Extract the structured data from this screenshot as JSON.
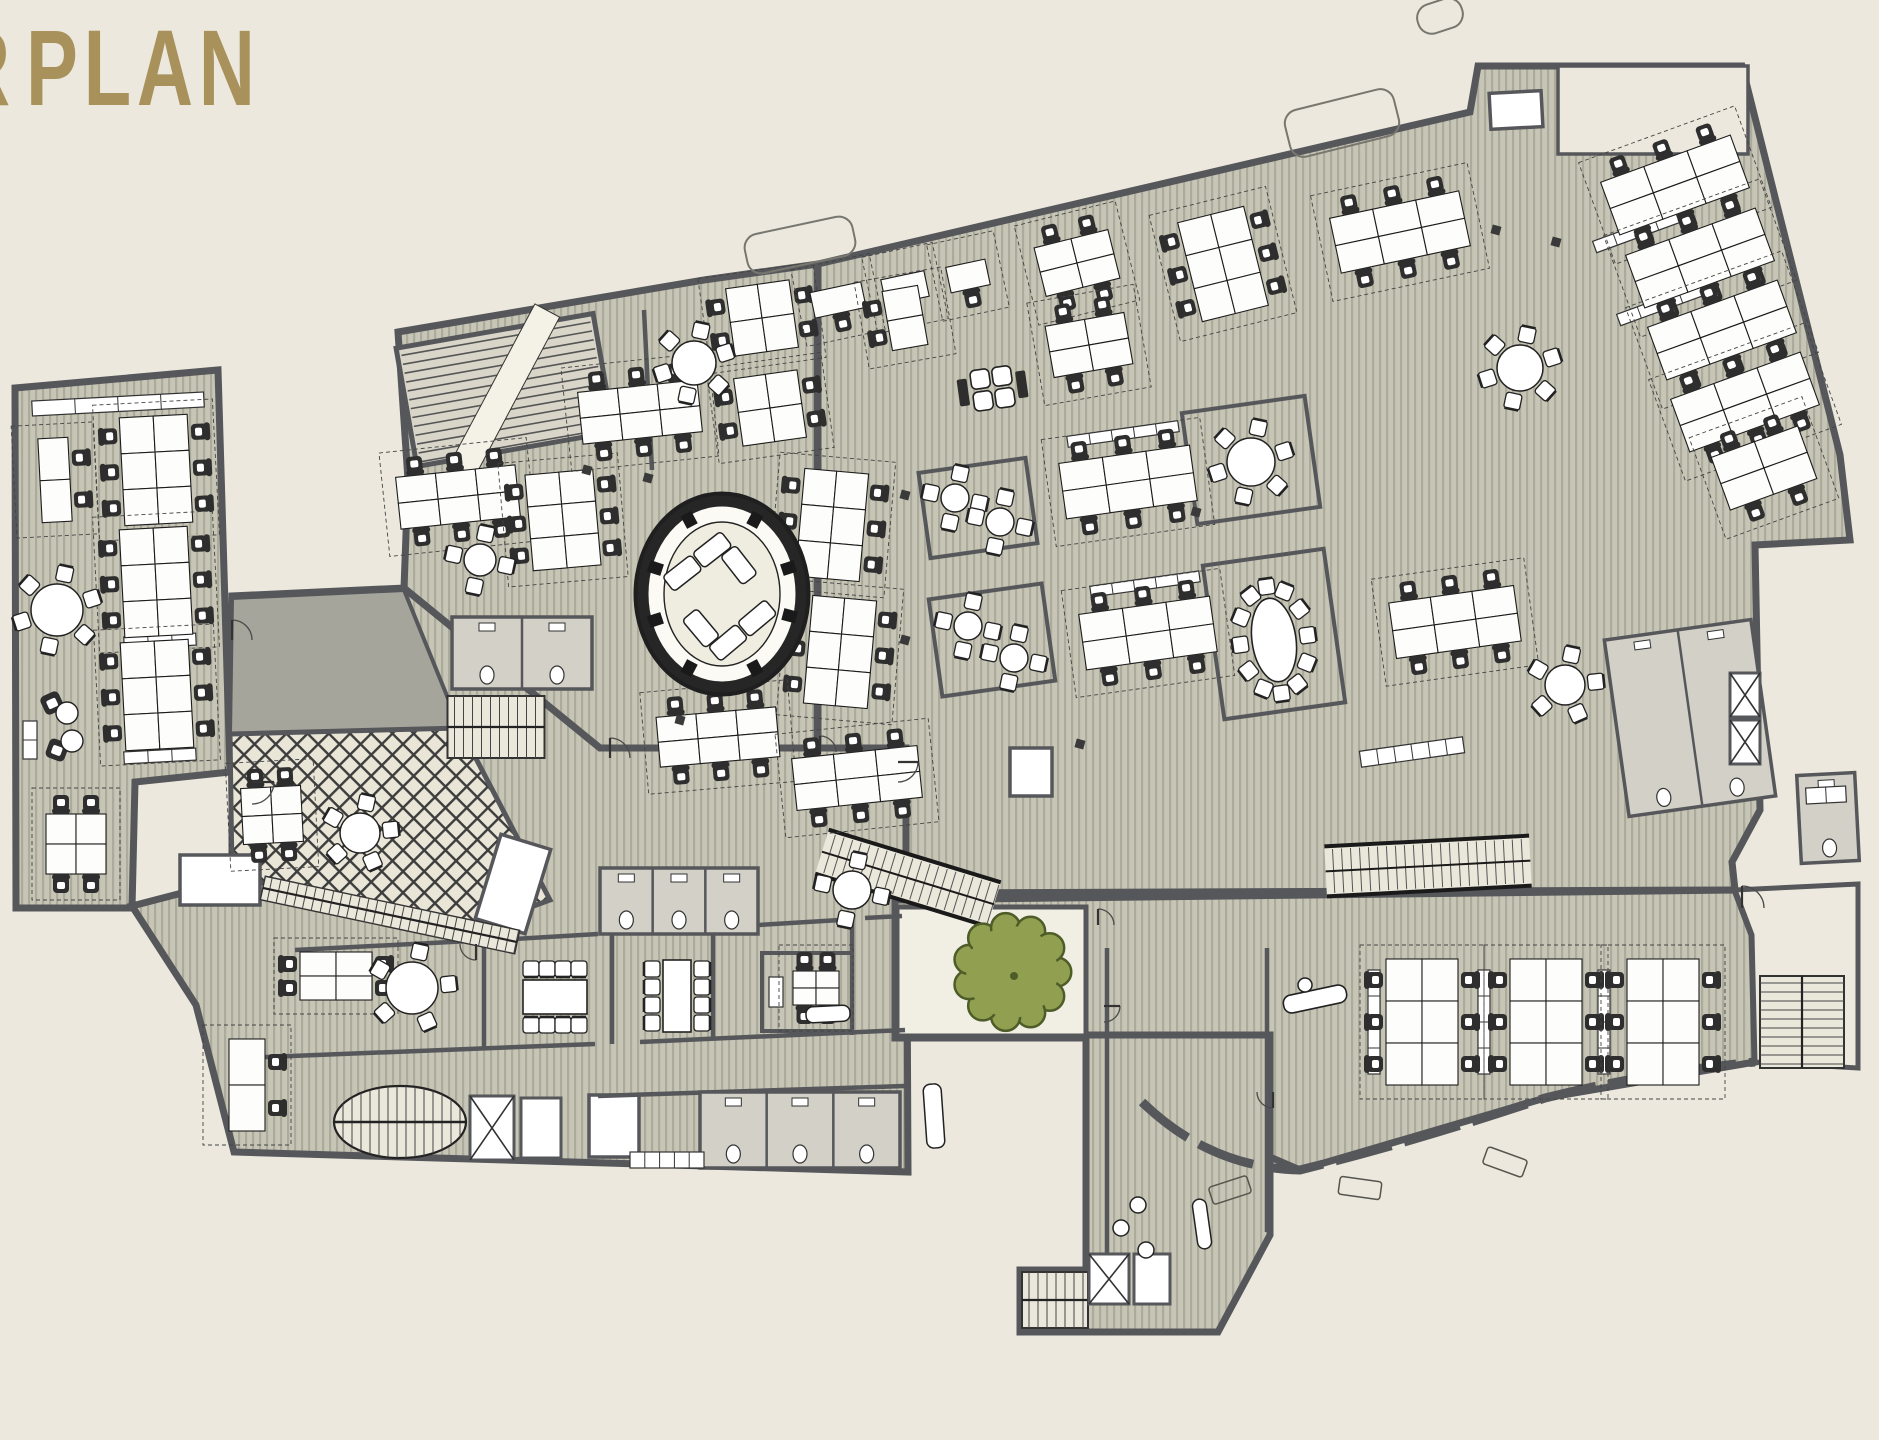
{
  "title": {
    "text": "PLAN",
    "partial_prefix_letter": "R"
  },
  "palette": {
    "bg": "#ECE8DD",
    "floor": "#C7C5B5",
    "stripe": "#ACAA9B",
    "wall": "#56575B",
    "wall_light": "#77766F",
    "lattice_bg": "#E9E5D7",
    "lattice_line": "#3D3D3D",
    "gray_wedge": "#A6A59B",
    "courtyard": "#F1EEE3",
    "vestibule": "#EDE9DE",
    "room_gray": "#D2D0C7",
    "stair_fill": "#EAE7DB",
    "furn_white": "#FDFDFB",
    "furn_line": "#1C1C1C",
    "chair_dark": "#2E2E2E",
    "tree_fill": "#90A050",
    "tree_line": "#4E5C28",
    "title_color": "#A8915A"
  },
  "canvas": {
    "w": 1879,
    "h": 1440
  },
  "plan": {
    "masses": [
      {
        "name": "left-wing",
        "pts": "15,388 218,370 230,772 135,782 132,908 16,908"
      },
      {
        "name": "lower-left-block",
        "pts": "132,906 232,880 232,596 404,588 600,748 906,748 908,1172 234,1152 196,1005"
      },
      {
        "name": "central-block",
        "pts": "398,332 704,280 818,264 818,748 600,748 404,588 408,480"
      },
      {
        "name": "right-block",
        "pts": "818,264 1470,112 1478,66 1742,66 1840,455 1850,540 1755,545 1760,810 1732,862 1735,890 906,893 906,748 818,748"
      },
      {
        "name": "bottom-right-block",
        "pts": "895,900 1735,890 1752,935 1755,1062 1545,1098 1300,1170 1142,1102 1086,1038 895,1038"
      },
      {
        "name": "lobby-tail",
        "pts": "1086,1035 1270,1035 1270,1235 1218,1332 1020,1332 1020,1270 1086,1270"
      }
    ],
    "gray_wedge": "232,598 404,590 460,728 230,734",
    "terrace": "230,734 460,728 550,900 468,930 232,876",
    "terrace_name": "lattice-terrace",
    "courtyard": "897,907 1086,907 1086,1036 897,1036",
    "vestibule": "1735,890 1858,884 1858,1068 1755,1062 1752,935",
    "tree": {
      "cx": 1012,
      "cy": 972,
      "r": 52
    },
    "bay_path": "M1142,1102 Q1210,1168 1300,1170 Q1420,1140 1545,1098 Q1650,1072 1755,1062",
    "oval_room": {
      "cx": 722,
      "cy": 594,
      "rx": 86,
      "ry": 100,
      "col_angles": [
        15,
        62,
        118,
        162,
        198,
        242,
        298,
        342
      ]
    },
    "white_rooms": [
      [
        513,
        884,
        52,
        88,
        17,
        "#FFFFFF"
      ],
      [
        220,
        880,
        80,
        50,
        0,
        "#FFFFFF"
      ],
      [
        1516,
        110,
        52,
        36,
        -3,
        "#FFFFFF"
      ],
      [
        1031,
        772,
        42,
        48,
        0,
        "#FFFFFF"
      ],
      [
        522,
        431,
        52,
        20,
        -8,
        "#FFFFFF"
      ],
      [
        614,
        1126,
        50,
        62,
        0,
        "#FFFFFF"
      ],
      [
        1653,
        110,
        190,
        88,
        0,
        "bg"
      ]
    ],
    "rooms_outline": [
      [
        978,
        508,
        108,
        86,
        -8
      ],
      [
        992,
        640,
        114,
        98,
        -8
      ],
      [
        1251,
        460,
        124,
        112,
        -8
      ],
      [
        1274,
        634,
        122,
        155,
        -8
      ],
      [
        807,
        992,
        90,
        78,
        0
      ]
    ],
    "wc_blocks": [
      [
        522,
        653,
        140,
        72,
        0,
        2
      ],
      [
        679,
        901,
        158,
        66,
        0,
        3
      ],
      [
        800,
        1130,
        200,
        76,
        0,
        3
      ],
      [
        1690,
        718,
        148,
        178,
        -8,
        2
      ],
      [
        1828,
        818,
        58,
        88,
        -3,
        1
      ]
    ],
    "desk_clusters": [
      [
        156,
        470,
        -3,
        2,
        3,
        34,
        36,
        "lr"
      ],
      [
        156,
        582,
        -3,
        2,
        3,
        34,
        36,
        "lr"
      ],
      [
        157,
        695,
        -3,
        2,
        3,
        34,
        36,
        "lr"
      ],
      [
        55,
        480,
        -3,
        1,
        2,
        30,
        42,
        "r"
      ],
      [
        76,
        844,
        0,
        2,
        2,
        30,
        30,
        "tb"
      ],
      [
        762,
        318,
        -8,
        2,
        2,
        32,
        34,
        "lr"
      ],
      [
        770,
        408,
        -8,
        2,
        2,
        32,
        34,
        "lr"
      ],
      [
        838,
        300,
        -12,
        1,
        1,
        52,
        26,
        "b"
      ],
      [
        905,
        288,
        -12,
        1,
        1,
        44,
        26,
        "b"
      ],
      [
        968,
        276,
        -12,
        1,
        1,
        40,
        26,
        "b"
      ],
      [
        1077,
        263,
        -14,
        2,
        2,
        38,
        25,
        "tb"
      ],
      [
        1223,
        264,
        -14,
        2,
        3,
        34,
        34,
        "lr"
      ],
      [
        1400,
        232,
        -12,
        3,
        2,
        44,
        28,
        "tb"
      ],
      [
        905,
        318,
        -10,
        1,
        2,
        36,
        30,
        "l"
      ],
      [
        1089,
        345,
        -10,
        2,
        2,
        40,
        26,
        "tb"
      ],
      [
        1128,
        482,
        -8,
        3,
        2,
        44,
        28,
        "tb"
      ],
      [
        1148,
        633,
        -8,
        3,
        2,
        44,
        28,
        "tb"
      ],
      [
        1455,
        622,
        -8,
        3,
        2,
        42,
        28,
        "tb"
      ],
      [
        458,
        497,
        -6,
        3,
        2,
        40,
        26,
        "tb"
      ],
      [
        563,
        520,
        -5,
        2,
        3,
        34,
        32,
        "lr"
      ],
      [
        640,
        412,
        -6,
        3,
        2,
        40,
        26,
        "tb"
      ],
      [
        832,
        525,
        5,
        2,
        3,
        32,
        36,
        "lr"
      ],
      [
        840,
        652,
        5,
        2,
        3,
        32,
        36,
        "lr"
      ],
      [
        718,
        737,
        -5,
        3,
        2,
        40,
        25,
        "tb"
      ],
      [
        857,
        778,
        -6,
        3,
        2,
        42,
        26,
        "tb"
      ],
      [
        1675,
        185,
        -20,
        3,
        2,
        46,
        28,
        "tb"
      ],
      [
        1700,
        258,
        -20,
        3,
        2,
        46,
        28,
        "tb"
      ],
      [
        1722,
        330,
        -20,
        3,
        2,
        46,
        28,
        "tb"
      ],
      [
        1745,
        402,
        -20,
        3,
        2,
        46,
        28,
        "tb"
      ],
      [
        1764,
        468,
        -20,
        2,
        2,
        46,
        28,
        "tb"
      ],
      [
        1422,
        1022,
        0,
        2,
        3,
        36,
        42,
        "lr"
      ],
      [
        1546,
        1022,
        0,
        2,
        3,
        36,
        42,
        "lr"
      ],
      [
        1663,
        1022,
        0,
        2,
        3,
        36,
        42,
        "lr"
      ],
      [
        247,
        1085,
        0,
        1,
        2,
        36,
        46,
        "r"
      ],
      [
        272,
        815,
        -3,
        2,
        2,
        30,
        28,
        "tb"
      ],
      [
        336,
        976,
        0,
        2,
        2,
        36,
        24,
        "lr"
      ],
      [
        816,
        988,
        0,
        2,
        2,
        23,
        17,
        "tb"
      ]
    ],
    "round_tables": [
      [
        57,
        610,
        26,
        6
      ],
      [
        360,
        833,
        20,
        5
      ],
      [
        412,
        988,
        26,
        5
      ],
      [
        694,
        363,
        22,
        6
      ],
      [
        480,
        560,
        16,
        4
      ],
      [
        852,
        890,
        19,
        4
      ],
      [
        1520,
        368,
        23,
        6
      ],
      [
        1565,
        685,
        20,
        5
      ],
      [
        1251,
        462,
        24,
        6
      ],
      [
        955,
        498,
        14,
        4
      ],
      [
        1000,
        522,
        14,
        4
      ],
      [
        968,
        626,
        14,
        4
      ],
      [
        1014,
        658,
        14,
        4
      ]
    ],
    "conf_tables": [
      [
        555,
        997,
        64,
        34,
        0,
        "tb",
        4
      ],
      [
        677,
        996,
        28,
        72,
        0,
        "lr",
        4
      ]
    ],
    "oval_table": {
      "cx": 1274,
      "cy": 640,
      "rx": 22,
      "ry": 42,
      "rot": -8,
      "n": 12
    },
    "booths": {
      "cx": 992,
      "cy": 388,
      "rot": -8
    },
    "lounge": {
      "chairs": [
        [
          52,
          703,
          -25
        ],
        [
          57,
          750,
          20
        ]
      ],
      "tables": [
        [
          67,
          713,
          11
        ],
        [
          72,
          741,
          11
        ]
      ]
    },
    "reception": [
      [
        1315,
        999,
        64,
        18,
        -12
      ]
    ],
    "sofa_bench": [
      [
        1202,
        1224,
        14,
        50,
        -8
      ],
      [
        934,
        1116,
        18,
        64,
        -4
      ],
      [
        828,
        1014,
        44,
        16,
        -3
      ]
    ],
    "stools": [
      [
        1138,
        1205,
        8
      ],
      [
        1121,
        1228,
        8
      ],
      [
        1146,
        1250,
        8
      ],
      [
        1305,
        985,
        7
      ]
    ],
    "stairs": [
      {
        "type": "hatch",
        "cx": 505,
        "cy": 390,
        "w": 200,
        "h": 120,
        "rot": -10
      },
      {
        "type": "tv",
        "cx": 496,
        "cy": 727,
        "w": 97,
        "h": 62,
        "rot": 0
      },
      {
        "type": "oval",
        "cx": 400,
        "cy": 1122,
        "rx": 66,
        "ry": 36
      },
      {
        "type": "run",
        "cx": 908,
        "cy": 878,
        "w": 180,
        "h": 46,
        "rot": 17
      },
      {
        "type": "run",
        "cx": 1428,
        "cy": 866,
        "w": 205,
        "h": 50,
        "rot": -3
      },
      {
        "type": "th",
        "cx": 1802,
        "cy": 1022,
        "w": 84,
        "h": 92,
        "rot": 0
      },
      {
        "type": "tv",
        "cx": 1055,
        "cy": 1300,
        "w": 66,
        "h": 56,
        "rot": 0
      },
      {
        "type": "strip",
        "cx": 390,
        "cy": 915,
        "w": 260,
        "h": 24,
        "rot": 12
      }
    ],
    "elevators": [
      [
        492,
        1128,
        44,
        64,
        "x"
      ],
      [
        541,
        1128,
        40,
        60,
        "p"
      ],
      [
        1109,
        1279,
        40,
        50,
        "x"
      ],
      [
        1152,
        1279,
        36,
        50,
        "p"
      ],
      [
        1745,
        695,
        30,
        44,
        "x"
      ],
      [
        1745,
        742,
        30,
        44,
        "x"
      ]
    ],
    "cabinets": [
      [
        118,
        404,
        172,
        15,
        -3,
        4
      ],
      [
        160,
        641,
        72,
        12,
        -3,
        3
      ],
      [
        160,
        756,
        72,
        12,
        -3,
        3
      ],
      [
        30,
        740,
        14,
        38,
        0,
        2
      ],
      [
        1123,
        434,
        112,
        11,
        -8,
        5
      ],
      [
        1145,
        584,
        110,
        11,
        -8,
        5
      ],
      [
        1636,
        232,
        88,
        12,
        -20,
        4
      ],
      [
        1660,
        305,
        88,
        12,
        -20,
        4
      ],
      [
        1412,
        752,
        104,
        16,
        -8,
        6
      ],
      [
        667,
        1160,
        74,
        16,
        0,
        5
      ],
      [
        1374,
        1022,
        12,
        104,
        0,
        4
      ],
      [
        1484,
        1022,
        12,
        104,
        0,
        4
      ],
      [
        1604,
        1022,
        12,
        104,
        0,
        4
      ],
      [
        1826,
        795,
        40,
        16,
        -3,
        2
      ],
      [
        776,
        992,
        14,
        30,
        0,
        1
      ]
    ],
    "inner_walls": [
      [
        600,
        748,
        906,
        748
      ],
      [
        906,
        748,
        906,
        893
      ],
      [
        816,
        268,
        816,
        748
      ],
      [
        295,
        950,
        470,
        941
      ],
      [
        498,
        940,
        598,
        934
      ],
      [
        625,
        933,
        700,
        928
      ],
      [
        726,
        927,
        840,
        920
      ],
      [
        865,
        918,
        902,
        916
      ],
      [
        484,
        942,
        484,
        1048
      ],
      [
        612,
        934,
        612,
        1044
      ],
      [
        713,
        926,
        713,
        1040
      ],
      [
        852,
        918,
        852,
        1035
      ],
      [
        240,
        1058,
        595,
        1044
      ],
      [
        640,
        1042,
        905,
        1030
      ],
      [
        598,
        1096,
        905,
        1086
      ],
      [
        906,
        893,
        1735,
        890
      ],
      [
        1107,
        948,
        1107,
        1270
      ],
      [
        1267,
        948,
        1267,
        1232
      ],
      [
        1086,
        1038,
        1086,
        1268
      ],
      [
        644,
        310,
        652,
        470
      ]
    ],
    "door_arcs": [
      [
        252,
        782,
        22,
        90
      ],
      [
        610,
        758,
        20,
        0
      ],
      [
        898,
        762,
        20,
        90
      ],
      [
        1098,
        925,
        16,
        0
      ],
      [
        1742,
        908,
        22,
        0
      ],
      [
        476,
        944,
        16,
        180
      ],
      [
        820,
        752,
        16,
        0
      ],
      [
        1104,
        1006,
        16,
        90
      ],
      [
        1273,
        1092,
        16,
        180
      ],
      [
        232,
        640,
        20,
        0
      ]
    ],
    "columns": [
      [
        1496,
        230
      ],
      [
        1556,
        242
      ],
      [
        905,
        495
      ],
      [
        905,
        640
      ],
      [
        1196,
        512
      ],
      [
        1080,
        744
      ],
      [
        680,
        720
      ],
      [
        648,
        478
      ],
      [
        587,
        470
      ]
    ],
    "canopies": [
      [
        1342,
        123,
        112,
        48,
        -14
      ],
      [
        800,
        245,
        110,
        40,
        -12
      ],
      [
        1440,
        16,
        46,
        30,
        -18
      ]
    ],
    "benches": [
      [
        1230,
        1190,
        40,
        18,
        -18
      ],
      [
        1360,
        1188,
        42,
        18,
        8
      ],
      [
        1505,
        1162,
        42,
        18,
        20
      ]
    ]
  }
}
